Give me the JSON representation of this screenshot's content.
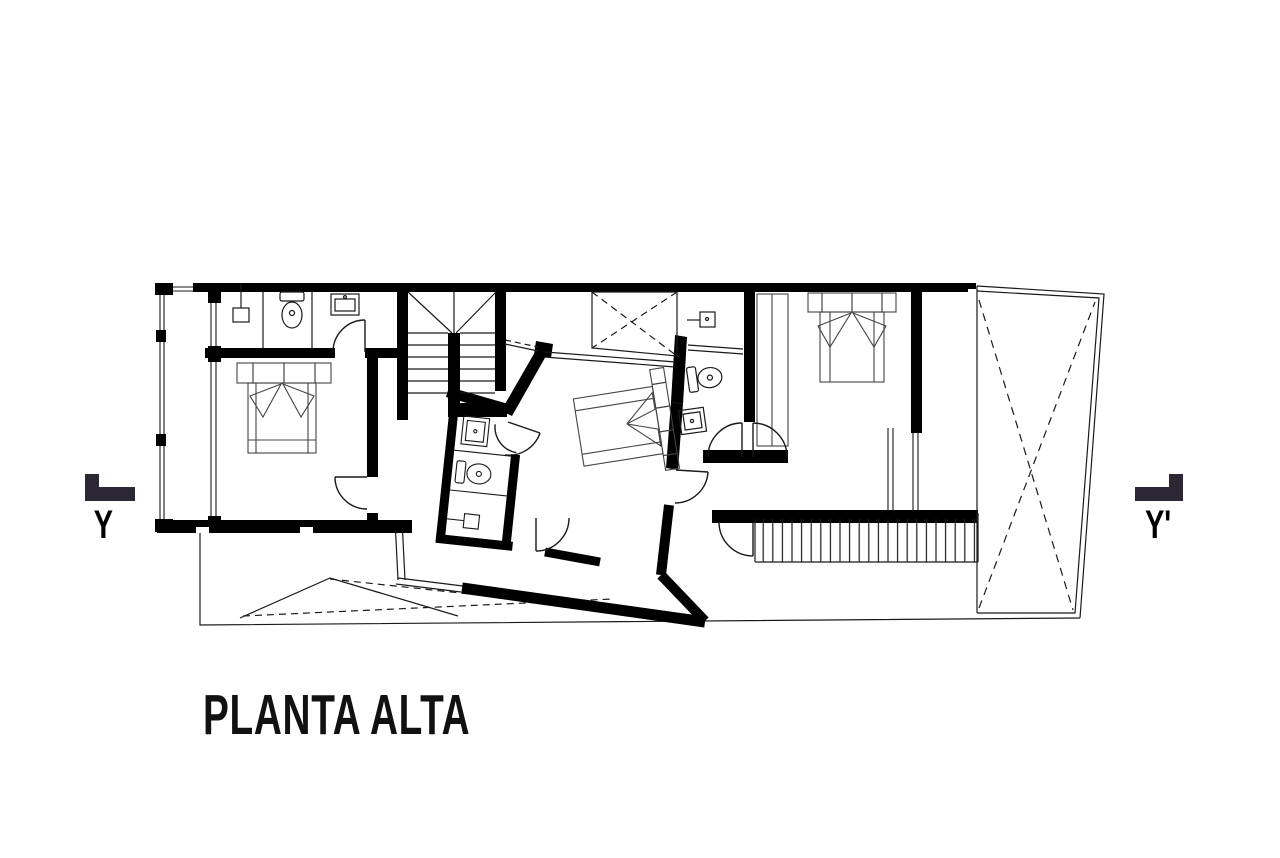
{
  "title": {
    "label": "PLANTA ALTA"
  },
  "section_markers": {
    "left": {
      "label": "Y"
    },
    "right": {
      "label": "Y'"
    }
  },
  "drawing": {
    "name": "upper-floor-plan",
    "fixture_icons": [
      "bed-icon",
      "toilet-icon",
      "sink-icon",
      "shower-icon",
      "stair-icon",
      "door-swing-icon",
      "void-x-icon",
      "louver-deck-icon",
      "roof-slope-icon",
      "wardrobe-icon",
      "window-glazing-icon"
    ]
  },
  "colors": {
    "background": "#ffffff",
    "linework": "#1a1a1a",
    "wall_fill": "#000000",
    "marker": "#2b2735"
  }
}
